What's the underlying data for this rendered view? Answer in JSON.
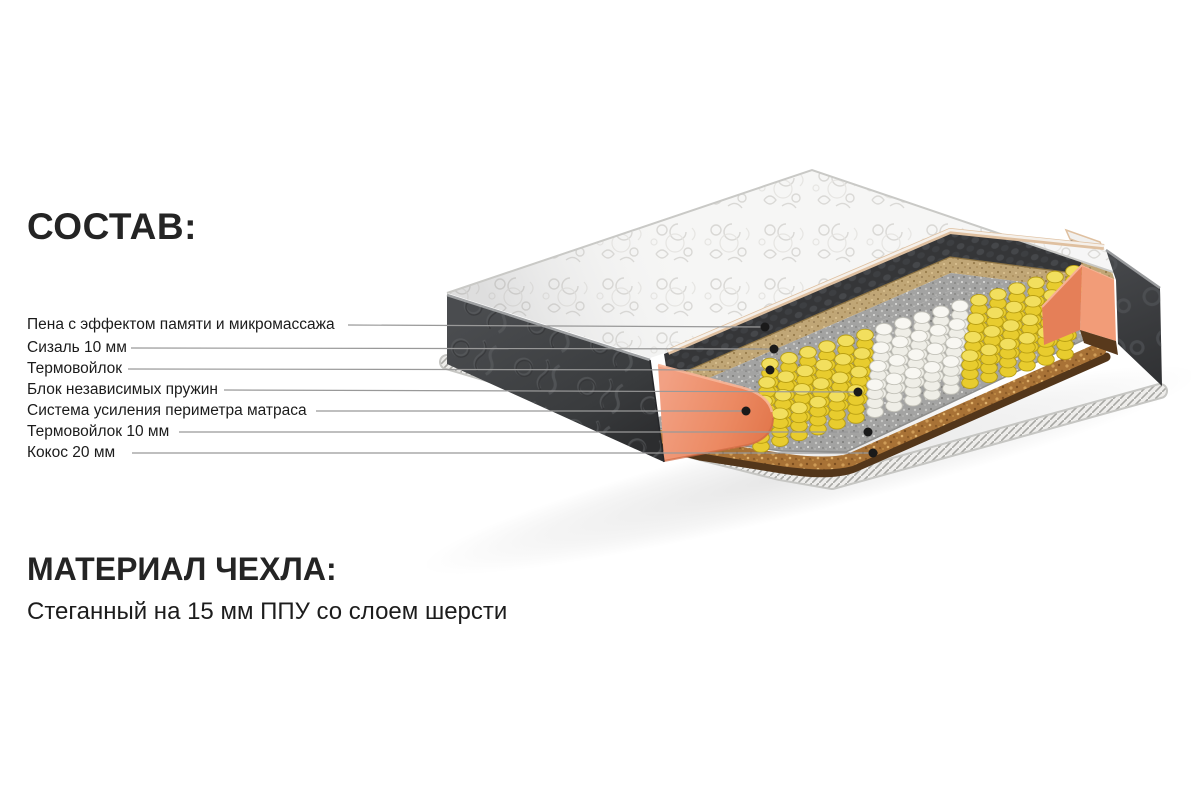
{
  "page": {
    "background": "#ffffff"
  },
  "composition": {
    "title": "СОСТАВ:",
    "layers": [
      {
        "label": "Пена с эффектом памяти и микромассажа",
        "y": 325,
        "line_start_x": 348,
        "dot": {
          "x": 765,
          "y": 327
        },
        "layer_color": "#37383a",
        "target": "memory-foam-layer"
      },
      {
        "label": "Сизаль 10 мм",
        "y": 348,
        "line_start_x": 131,
        "dot": {
          "x": 774,
          "y": 349
        },
        "layer_color": "#c0a676",
        "target": "sisal-layer"
      },
      {
        "label": "Термовойлок",
        "y": 369,
        "line_start_x": 128,
        "dot": {
          "x": 770,
          "y": 370
        },
        "layer_color": "#a3a3a2",
        "target": "thermofelt-layer"
      },
      {
        "label": "Блок независимых пружин",
        "y": 390,
        "line_start_x": 224,
        "dot": {
          "x": 858,
          "y": 392
        },
        "layer_color": "#e8cc2e",
        "target": "spring-block"
      },
      {
        "label": "Система усиления периметра матраса",
        "y": 411,
        "line_start_x": 316,
        "dot": {
          "x": 746,
          "y": 411
        },
        "layer_color": "#ee8f6d",
        "target": "perimeter-band"
      },
      {
        "label": "Термовойлок 10 мм",
        "y": 432,
        "line_start_x": 179,
        "dot": {
          "x": 868,
          "y": 432
        },
        "layer_color": "#a3a3a2",
        "target": "thermofelt-bottom-layer"
      },
      {
        "label": "Кокос 20 мм",
        "y": 453,
        "line_start_x": 132,
        "dot": {
          "x": 873,
          "y": 453
        },
        "layer_color": "#a87236",
        "target": "coconut-layer"
      }
    ]
  },
  "cover": {
    "title": "МАТЕРИАЛ ЧЕХЛА:",
    "description": "Стеганный на 15 мм ППУ со слоем шерсти"
  },
  "illustration": {
    "type": "mattress-cutaway",
    "colors": {
      "quilt_base": "#f6f6f5",
      "side_panel": "#3e4043",
      "memory_foam": "#37383a",
      "sisal": "#c0a676",
      "thermofelt": "#a3a3a2",
      "spring_yellow": "#e8cc2e",
      "spring_white": "#efeee7",
      "perimeter_orange": "#ee8f6d",
      "coconut_top": "#a87236",
      "coconut_side": "#53361a",
      "piping": "#eeedeb",
      "leader_line": "#999999",
      "dot": "#1a1a1a",
      "text": "#1b1b1b"
    },
    "springs": {
      "columns": 17,
      "rows": 4,
      "origin": [
        770,
        391
      ],
      "col_step": [
        19,
        -5.8
      ],
      "row_step": [
        -3,
        18.5
      ],
      "coil_rx": 8.3,
      "coil_ry": 5.8,
      "coil_count": 4,
      "coil_gap": 9,
      "white_col_start": 6,
      "white_col_end": 10,
      "yellow": "#e8cc2e",
      "yellow_stroke": "#b99f12",
      "yellow_top": "#f2df5e",
      "white": "#efeee7",
      "white_stroke": "#c3c2b9",
      "white_top": "#f8f7f2"
    }
  }
}
